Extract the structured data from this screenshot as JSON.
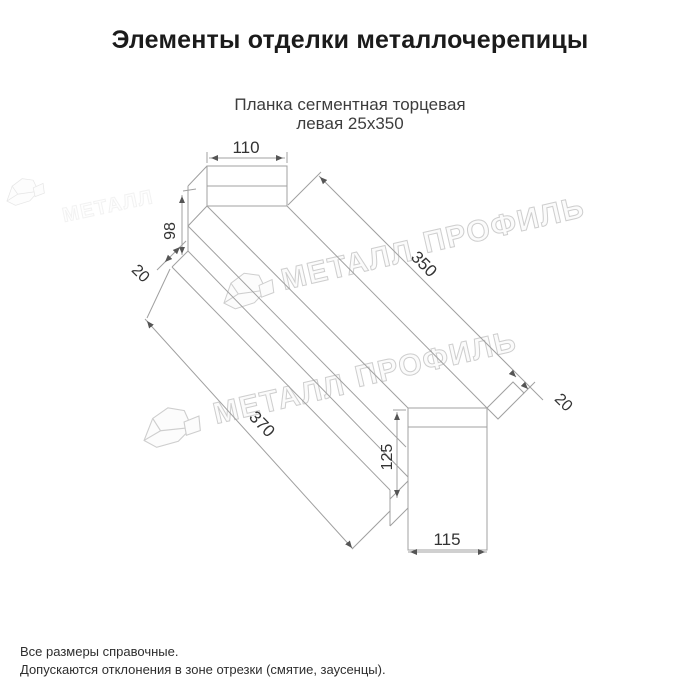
{
  "page": {
    "title": "Элементы отделки металлочерепицы"
  },
  "product": {
    "subtitle_line1": "Планка сегментная торцевая",
    "subtitle_line2": "левая 25х350"
  },
  "dimensions": {
    "top_width": "110",
    "left_height": "98",
    "left_hem": "20",
    "length_top": "350",
    "right_hem": "20",
    "length_bottom": "370",
    "right_height": "125",
    "bottom_width": "115"
  },
  "watermark": {
    "word1": "МЕТАЛЛ",
    "word2": "ПРОФИЛЬ"
  },
  "footnotes": {
    "line1": "Все размеры справочные.",
    "line2": "Допускаются отклонения в зоне отрезки (смятие, заусенцы)."
  },
  "colors": {
    "line": "#a0a0a0",
    "dim_text": "#333333",
    "watermark": "#c9c9c9"
  }
}
